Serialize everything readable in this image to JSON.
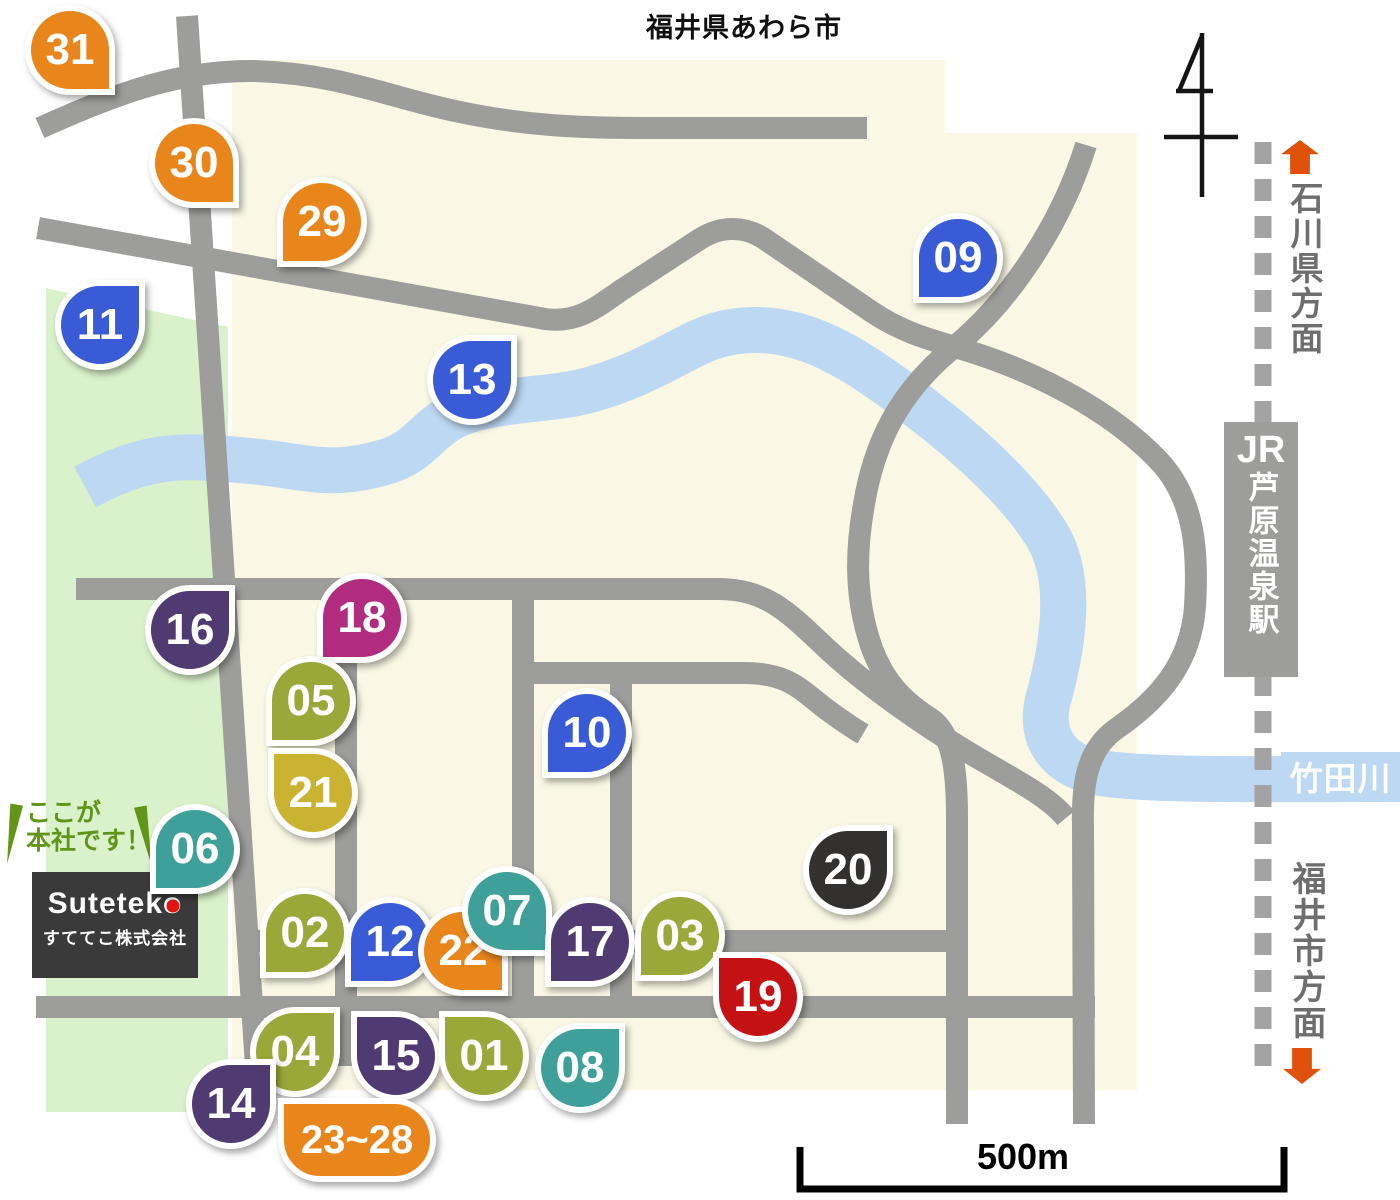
{
  "title": "福井県あわら市",
  "callout": {
    "line1": "ここが",
    "line2": "本社です！"
  },
  "logo": {
    "head": "Sutetek",
    "tail": "o",
    "company": "すててこ株式会社"
  },
  "station": {
    "jr": "JR",
    "name": "芦原温泉駅"
  },
  "river": {
    "name": "竹田川"
  },
  "directions": {
    "north": "石川県方面",
    "south": "福井市方面"
  },
  "scale": {
    "label": "500m"
  },
  "colors": {
    "map_bg": "#FFFFFF",
    "land": "#FAF8E5",
    "park": "#DAF2CB",
    "river": "#BDD8F3",
    "road": "#9D9D9B",
    "railway": "#A3A3A3",
    "station_bg": "#9D9D9B",
    "direction_arrow": "#E0520B",
    "direction_text": "#6E6E6E",
    "callout_text": "#609518",
    "logo_bg": "#3A3A3A",
    "logo_dot": "#E3130F",
    "pin_orange": "#E8861C",
    "pin_blue": "#3A5BD6",
    "pin_teal": "#3FA099",
    "pin_olive": "#9AA83A",
    "pin_mustard": "#C9B330",
    "pin_purple": "#4F3A72",
    "pin_magenta": "#B12C7F",
    "pin_red": "#C41114",
    "pin_black": "#333030"
  },
  "pins": [
    {
      "id": "31",
      "label": "31",
      "x": 70,
      "y": 50,
      "color": "pin_orange",
      "corner": "br"
    },
    {
      "id": "30",
      "label": "30",
      "x": 194,
      "y": 163,
      "color": "pin_orange",
      "corner": "br"
    },
    {
      "id": "29",
      "label": "29",
      "x": 322,
      "y": 222,
      "color": "pin_orange",
      "corner": "bl"
    },
    {
      "id": "11",
      "label": "11",
      "x": 100,
      "y": 325,
      "color": "pin_blue",
      "corner": "tr"
    },
    {
      "id": "13",
      "label": "13",
      "x": 472,
      "y": 380,
      "color": "pin_blue",
      "corner": "tr"
    },
    {
      "id": "09",
      "label": "09",
      "x": 958,
      "y": 258,
      "color": "pin_blue",
      "corner": "bl"
    },
    {
      "id": "16",
      "label": "16",
      "x": 190,
      "y": 630,
      "color": "pin_purple",
      "corner": "tr"
    },
    {
      "id": "18",
      "label": "18",
      "x": 362,
      "y": 618,
      "color": "pin_magenta",
      "corner": "bl"
    },
    {
      "id": "05",
      "label": "05",
      "x": 311,
      "y": 701,
      "color": "pin_olive",
      "corner": "bl"
    },
    {
      "id": "10",
      "label": "10",
      "x": 587,
      "y": 733,
      "color": "pin_blue",
      "corner": "bl"
    },
    {
      "id": "21",
      "label": "21",
      "x": 313,
      "y": 793,
      "color": "pin_mustard",
      "corner": "tl"
    },
    {
      "id": "06",
      "label": "06",
      "x": 195,
      "y": 849,
      "color": "pin_teal",
      "corner": "bl"
    },
    {
      "id": "20",
      "label": "20",
      "x": 848,
      "y": 870,
      "color": "pin_black",
      "corner": "tr"
    },
    {
      "id": "02",
      "label": "02",
      "x": 305,
      "y": 933,
      "color": "pin_olive",
      "corner": "bl"
    },
    {
      "id": "12",
      "label": "12",
      "x": 390,
      "y": 942,
      "color": "pin_blue",
      "corner": "bl"
    },
    {
      "id": "22",
      "label": "22",
      "x": 463,
      "y": 951,
      "color": "pin_orange",
      "corner": "br"
    },
    {
      "id": "07",
      "label": "07",
      "x": 507,
      "y": 911,
      "color": "pin_teal",
      "corner": "br"
    },
    {
      "id": "17",
      "label": "17",
      "x": 590,
      "y": 942,
      "color": "pin_purple",
      "corner": "bl"
    },
    {
      "id": "03",
      "label": "03",
      "x": 680,
      "y": 936,
      "color": "pin_olive",
      "corner": "bl"
    },
    {
      "id": "19",
      "label": "19",
      "x": 758,
      "y": 997,
      "color": "pin_red",
      "corner": "tl"
    },
    {
      "id": "04",
      "label": "04",
      "x": 295,
      "y": 1052,
      "color": "pin_olive",
      "corner": "tr"
    },
    {
      "id": "15",
      "label": "15",
      "x": 396,
      "y": 1056,
      "color": "pin_purple",
      "corner": "tl"
    },
    {
      "id": "01",
      "label": "01",
      "x": 484,
      "y": 1056,
      "color": "pin_olive",
      "corner": "tl"
    },
    {
      "id": "08",
      "label": "08",
      "x": 580,
      "y": 1068,
      "color": "pin_teal",
      "corner": "tr"
    },
    {
      "id": "14",
      "label": "14",
      "x": 231,
      "y": 1104,
      "color": "pin_purple",
      "corner": "tr"
    },
    {
      "id": "23-28",
      "label": "23~28",
      "x": 357,
      "y": 1140,
      "color": "pin_orange",
      "corner": "tl",
      "wide": true
    }
  ]
}
